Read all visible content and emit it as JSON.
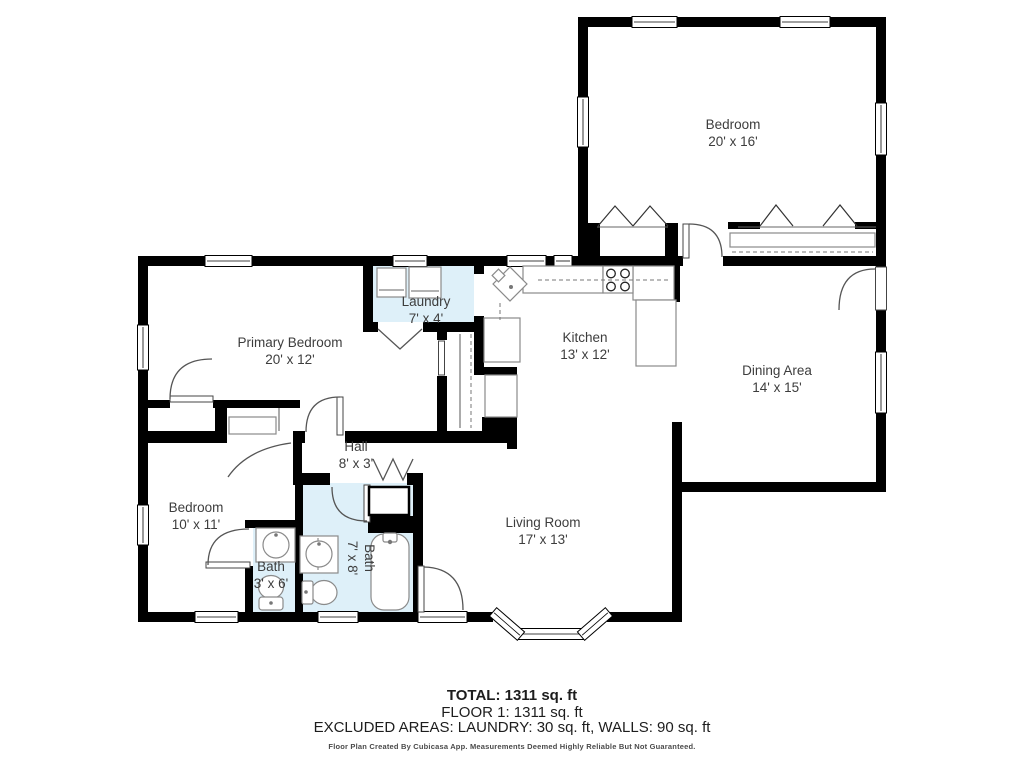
{
  "rooms": {
    "bedroom_upper": {
      "name": "Bedroom",
      "dims": "20' x 16'"
    },
    "primary_bedroom": {
      "name": "Primary Bedroom",
      "dims": "20' x 12'"
    },
    "laundry": {
      "name": "Laundry",
      "dims": "7' x 4'"
    },
    "kitchen": {
      "name": "Kitchen",
      "dims": "13' x 12'"
    },
    "dining_area": {
      "name": "Dining Area",
      "dims": "14' x 15'"
    },
    "hall": {
      "name": "Hall",
      "dims": "8' x 3'"
    },
    "bedroom_lower": {
      "name": "Bedroom",
      "dims": "10' x 11'"
    },
    "bath_small": {
      "name": "Bath",
      "dims": "3' x 6'"
    },
    "bath_large": {
      "name": "Bath",
      "dims": "7' x 8'"
    },
    "living_room": {
      "name": "Living Room",
      "dims": "17' x 13'"
    }
  },
  "summary": {
    "total": "TOTAL: 1311 sq. ft",
    "floor": "FLOOR 1: 1311 sq. ft",
    "excluded": "EXCLUDED AREAS: LAUNDRY: 30 sq. ft, WALLS: 90 sq. ft",
    "disclaimer": "Floor Plan Created By Cubicasa App. Measurements Deemed Highly Reliable But Not Guaranteed."
  },
  "colors": {
    "wall": "#000000",
    "wet_room_fill": "#def0f9",
    "fixture_stroke": "#8a8a8a",
    "label_text": "#3d3d3d"
  }
}
